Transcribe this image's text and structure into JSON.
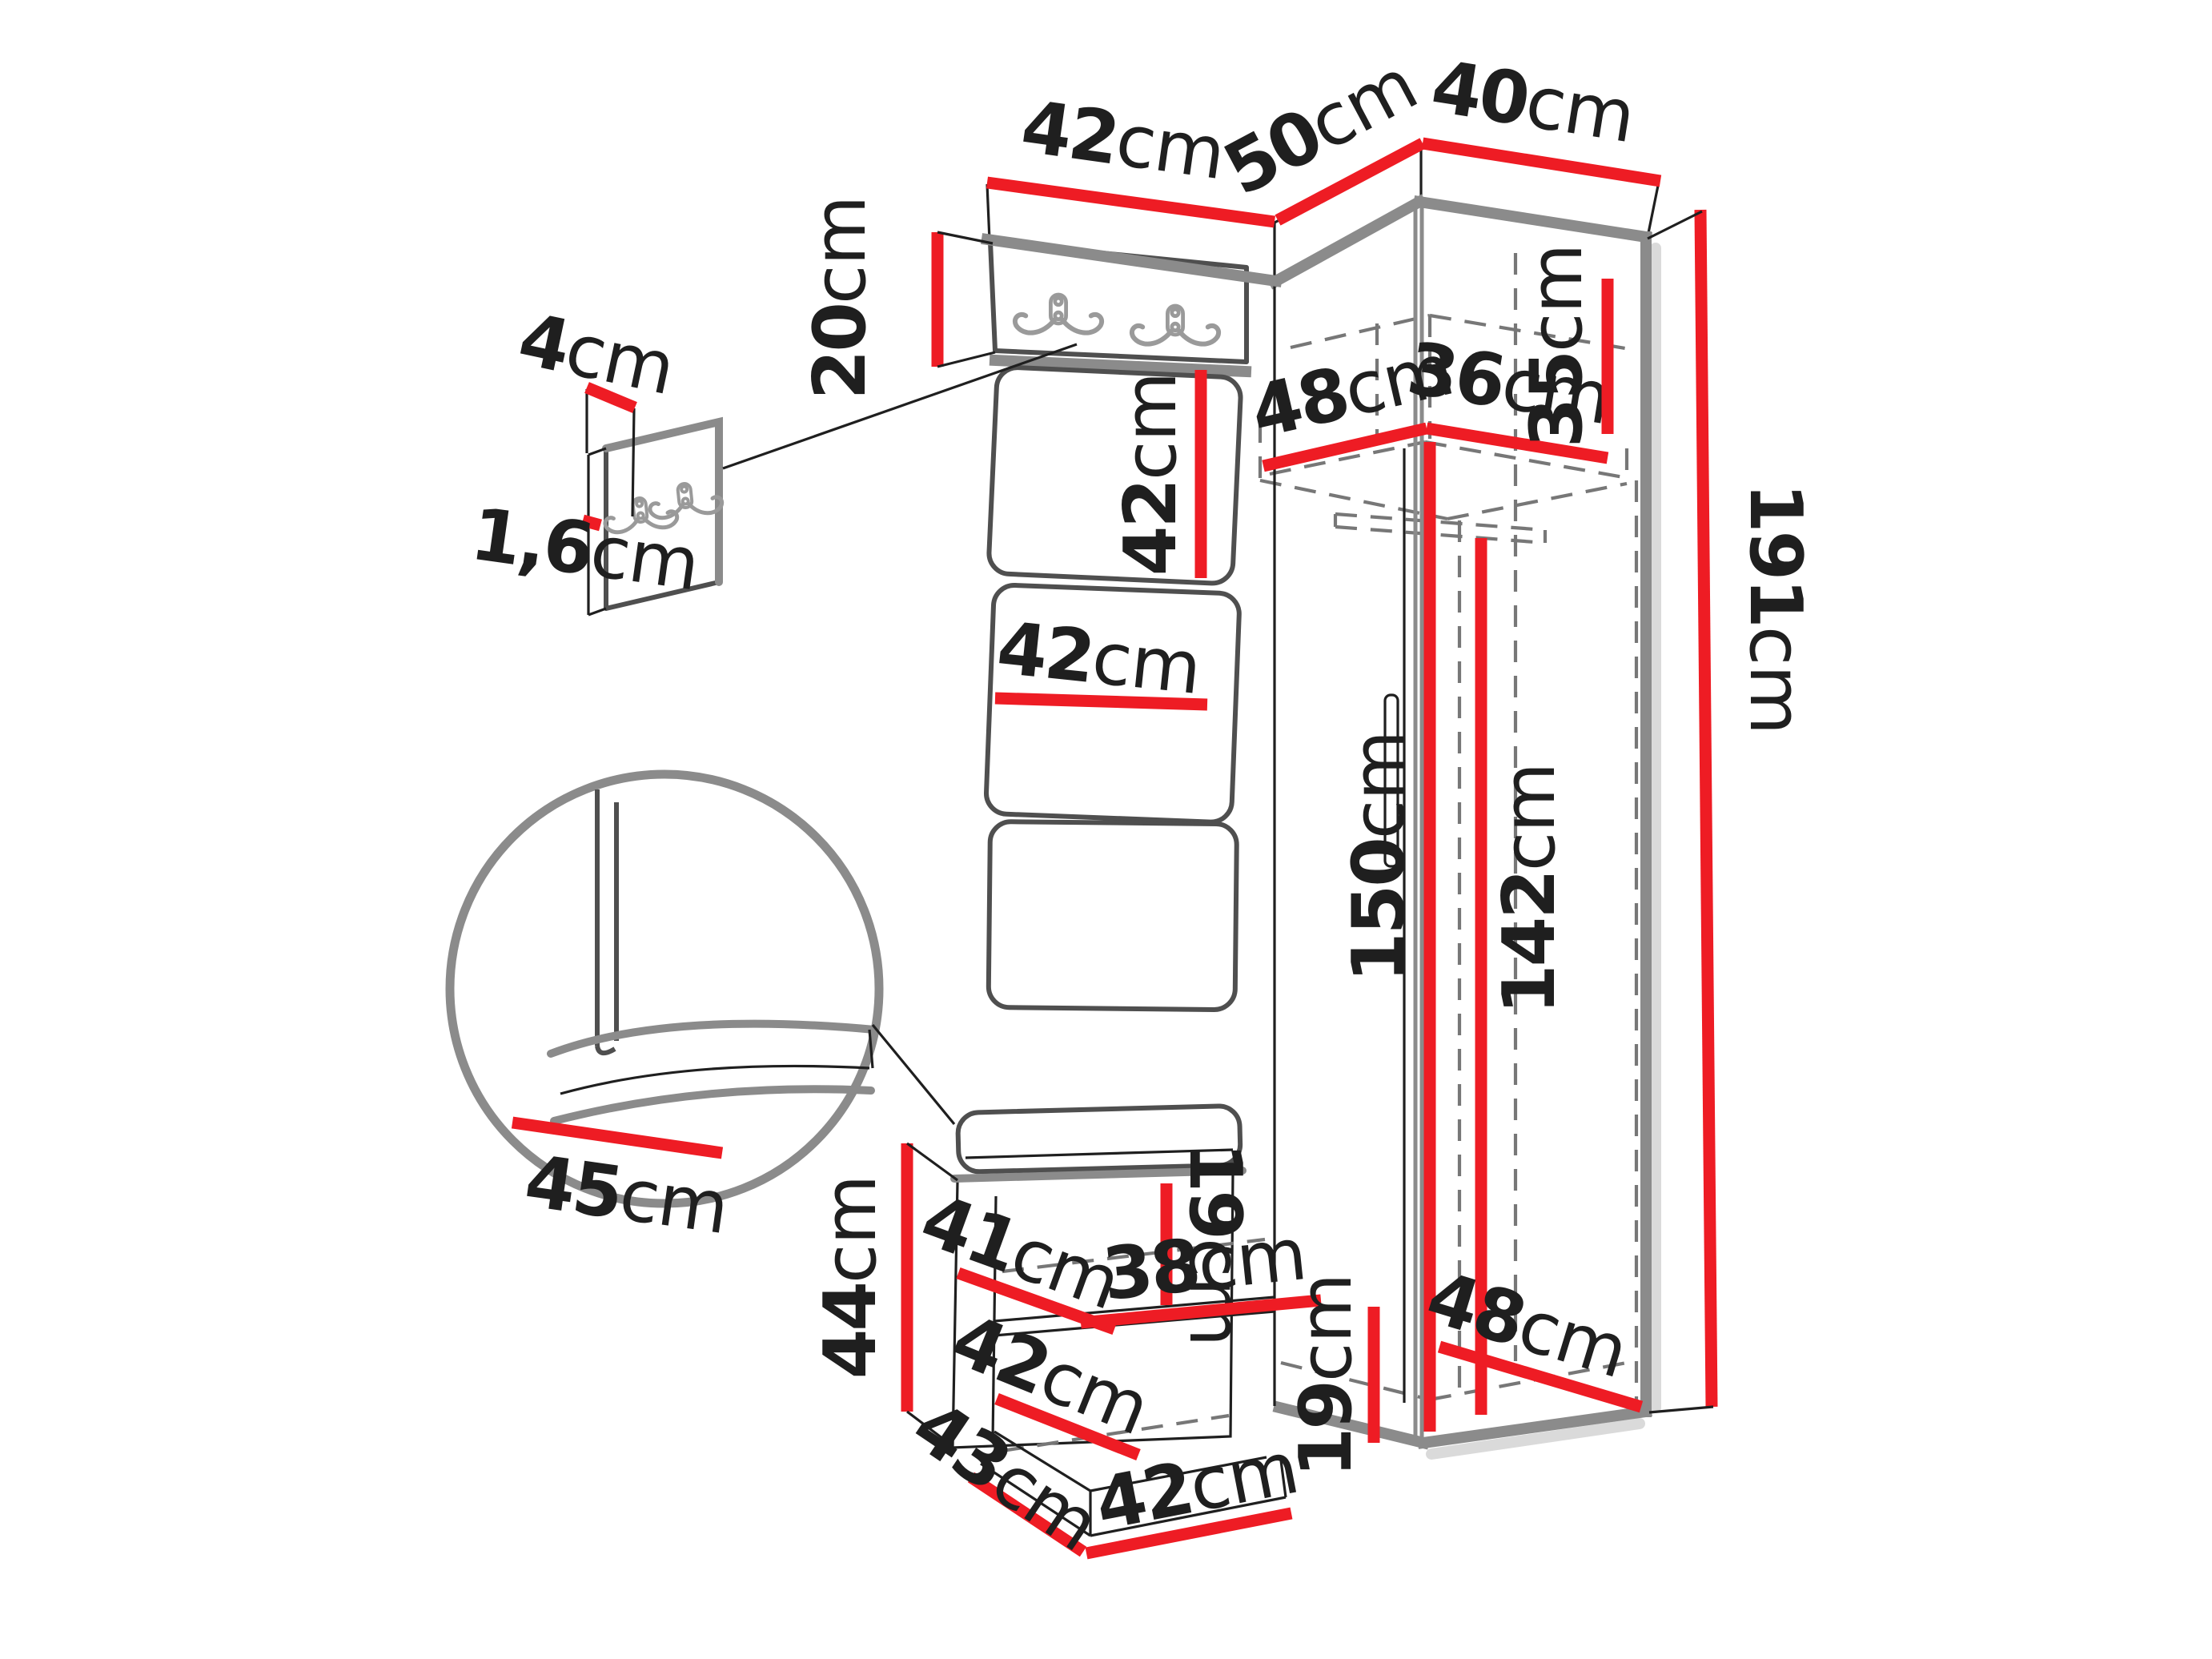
{
  "colors": {
    "dimension_red": "#ee1c24",
    "edge_gray": "#8b8b8b",
    "panel_outline": "#4f4f4f",
    "line_black": "#1f1f1f",
    "dash_gray": "#777777",
    "detail_gray": "#9a9a9a",
    "shadow_gray": "#dadada",
    "background": "#ffffff"
  },
  "dims": {
    "top_panel_width": {
      "value": "42",
      "unit": "cm"
    },
    "top_left_depth": {
      "value": "50",
      "unit": "cm"
    },
    "top_right_depth": {
      "value": "40",
      "unit": "cm"
    },
    "hook_panel_height": {
      "value": "20",
      "unit": "cm"
    },
    "detail_hook_offset": {
      "value": "4",
      "unit": "cm"
    },
    "detail_panel_thickness": {
      "value": "1,6",
      "unit": "cm"
    },
    "padded_panel_height": {
      "value": "42",
      "unit": "cm"
    },
    "padded_panel_width": {
      "value": "42",
      "unit": "cm"
    },
    "top_shelf_depth": {
      "value": "48",
      "unit": "cm"
    },
    "top_shelf_width": {
      "value": "36",
      "unit": "cm"
    },
    "top_compartment_height": {
      "value": "35",
      "unit": "cm"
    },
    "total_height": {
      "value": "191",
      "unit": "cm"
    },
    "niche_height": {
      "value": "150",
      "unit": "cm"
    },
    "wardrobe_interior_height": {
      "value": "142",
      "unit": "cm"
    },
    "bench_seat_depth": {
      "value": "45",
      "unit": "cm"
    },
    "bench_height": {
      "value": "44",
      "unit": "cm"
    },
    "bench_shelf_depth": {
      "value": "41",
      "unit": "cm"
    },
    "bench_opening_height": {
      "value": "19",
      "unit": "cm"
    },
    "bench_shelf_width": {
      "value": "38",
      "unit": "cm"
    },
    "bench_compartment_width": {
      "value": "42",
      "unit": "cm"
    },
    "wardrobe_base_height": {
      "value": "19",
      "unit": "cm"
    },
    "wardrobe_base_depth": {
      "value": "48",
      "unit": "cm"
    },
    "plinth_side_depth": {
      "value": "43",
      "unit": "cm"
    },
    "plinth_front_width": {
      "value": "42",
      "unit": "cm"
    }
  }
}
